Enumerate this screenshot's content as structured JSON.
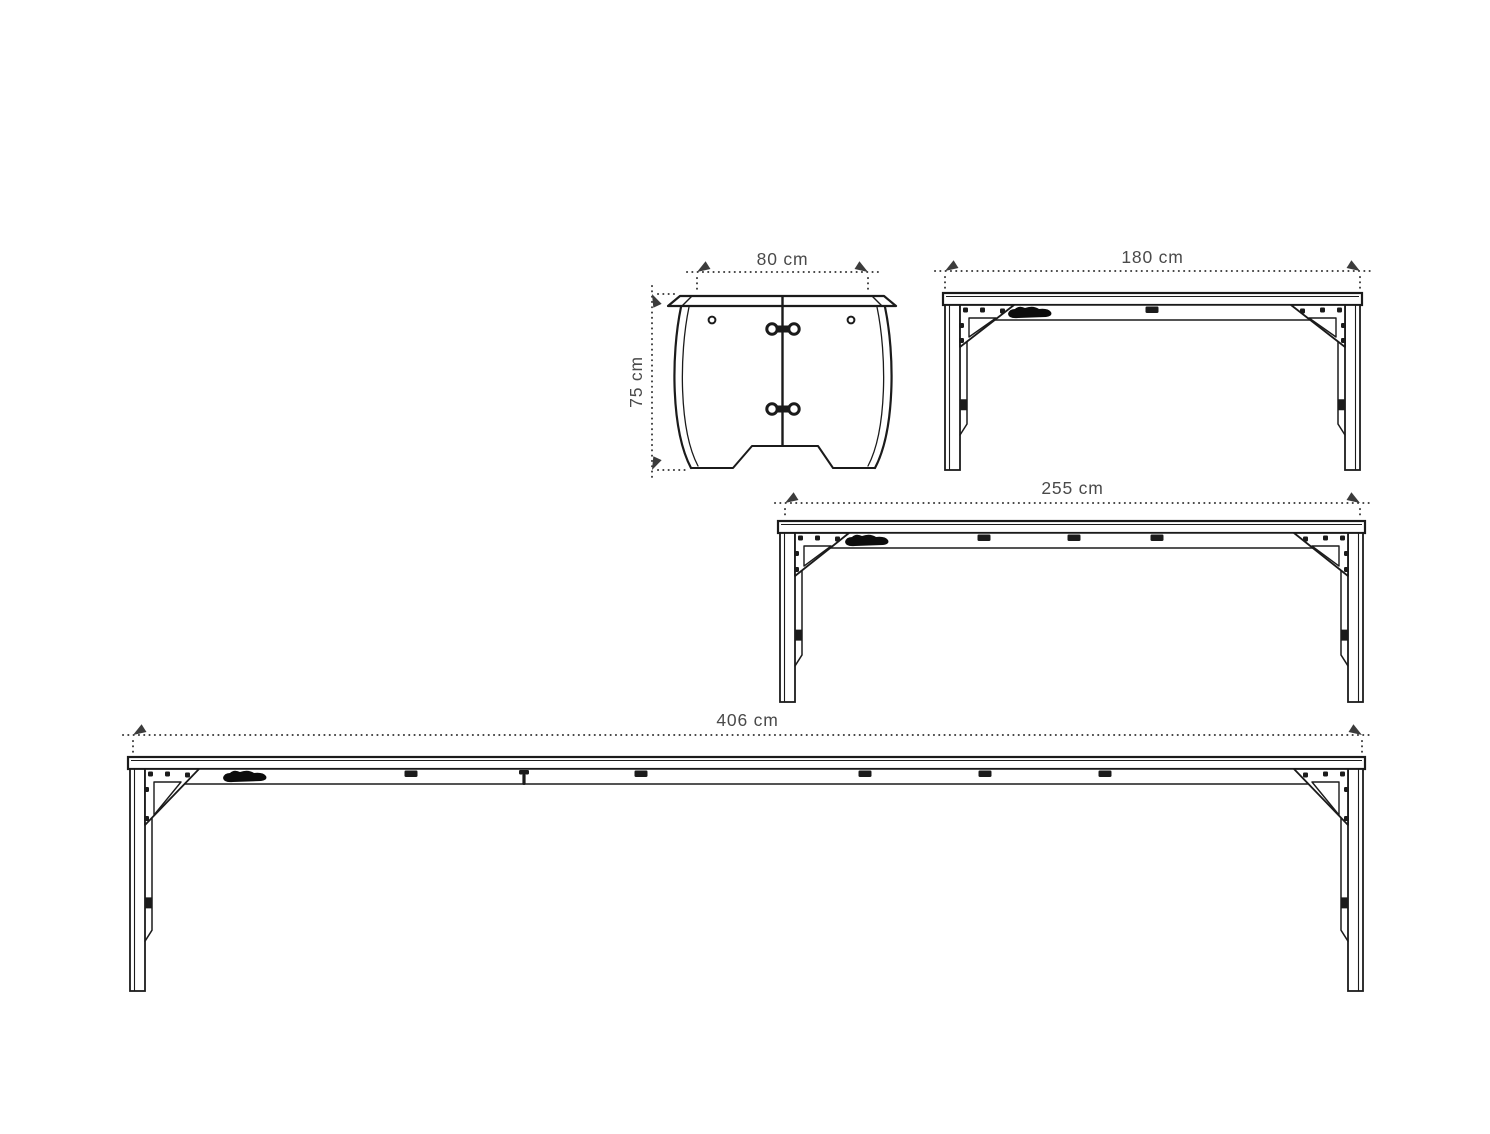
{
  "colors": {
    "background": "#ffffff",
    "line": "#1b1b1b",
    "dim_line": "#3c3c3c",
    "dim_text": "#4a4a4a",
    "logo": "#0c0c0c"
  },
  "drawing": {
    "end_view": {
      "width_label": "80 cm",
      "height_label": "75 cm"
    },
    "side_views": [
      {
        "length_label": "180 cm"
      },
      {
        "length_label": "255 cm"
      },
      {
        "length_label": "406 cm"
      }
    ]
  }
}
